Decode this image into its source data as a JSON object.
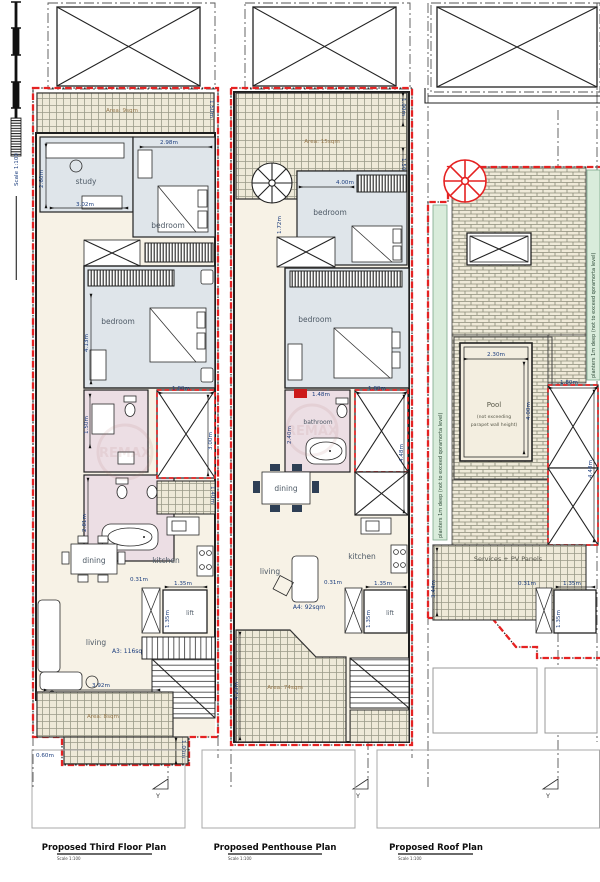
{
  "scalebar": {
    "label": "Scale 1:100"
  },
  "watermark": {
    "text": "REMAX"
  },
  "plan1": {
    "title": "Proposed Third Floor Plan",
    "scale_note": "Scale 1:100",
    "section_marker": "Y",
    "areas": {
      "top_terrace": "Area: 9sqm",
      "bottom_balcony": "Area: 8sqm",
      "apartment": "A3: 116sqm"
    },
    "rooms": {
      "study": "study",
      "bedroom1": "bedroom",
      "bedroom2": "bedroom",
      "dining": "dining",
      "kitchen": "kitchen",
      "living": "living",
      "lift": "lift"
    },
    "dims": {
      "study_h": "2.60m",
      "study_w": "3.02m",
      "bed1_w": "2.98m",
      "bed2_h": "4.13m",
      "bath1_h": "1.50m",
      "bath2_h": "2.81m",
      "shaft_w": "1.80m",
      "shaft_h": "3.00m",
      "yard_h": "1.40m",
      "terrace_h": "1.50m",
      "step": "0.31m",
      "lift_w": "1.35m",
      "lift_h": "1.35m",
      "living_w": "3.92m",
      "balcony_d": "1.00m",
      "balcony_s": "0.60m"
    }
  },
  "plan2": {
    "title": "Proposed Penthouse Plan",
    "scale_note": "Scale 1:100",
    "section_marker": "Y",
    "areas": {
      "top_terrace": "Area: 15sqm",
      "bottom_terrace": "Area: 74sqm",
      "apartment": "A4: 92sqm"
    },
    "rooms": {
      "bedroom1": "bedroom",
      "bedroom2": "bedroom",
      "bathroom": "bathroom",
      "dining": "dining",
      "kitchen": "kitchen",
      "living": "living",
      "lift": "lift"
    },
    "dims": {
      "terrace_d1": "1.00m",
      "terrace_d2": "1.50m",
      "bed1_w": "4.00m",
      "hall_h": "1.72m",
      "bath_h": "2.40m",
      "tub_l": "1.48m",
      "shaft_w": "1.80m",
      "shaft_h": "4.48m",
      "terrace_h": "4.23m",
      "step": "0.31m",
      "lift_w": "1.35m",
      "lift_h": "1.35m"
    }
  },
  "plan3": {
    "title": "Proposed Roof Plan",
    "scale_note": "Scale 1:100",
    "section_marker": "Y",
    "planter_left": "planters 1m deep (not to exceed qoramorta level)",
    "planter_right": "planters 1m deep (not to exceed qoramorta level)",
    "pool": {
      "label": "Pool",
      "note1": "(not exceeding",
      "note2": "parapet wall height)",
      "w": "2.30m",
      "h": "4.00m"
    },
    "services": "Services + PV Panels",
    "dims": {
      "services_h": "3.44m",
      "shaft_w": "1.80m",
      "shaft_h": "4.48m",
      "step": "0.31m",
      "lift_w": "1.35m",
      "lift_h": "1.35m"
    }
  }
}
